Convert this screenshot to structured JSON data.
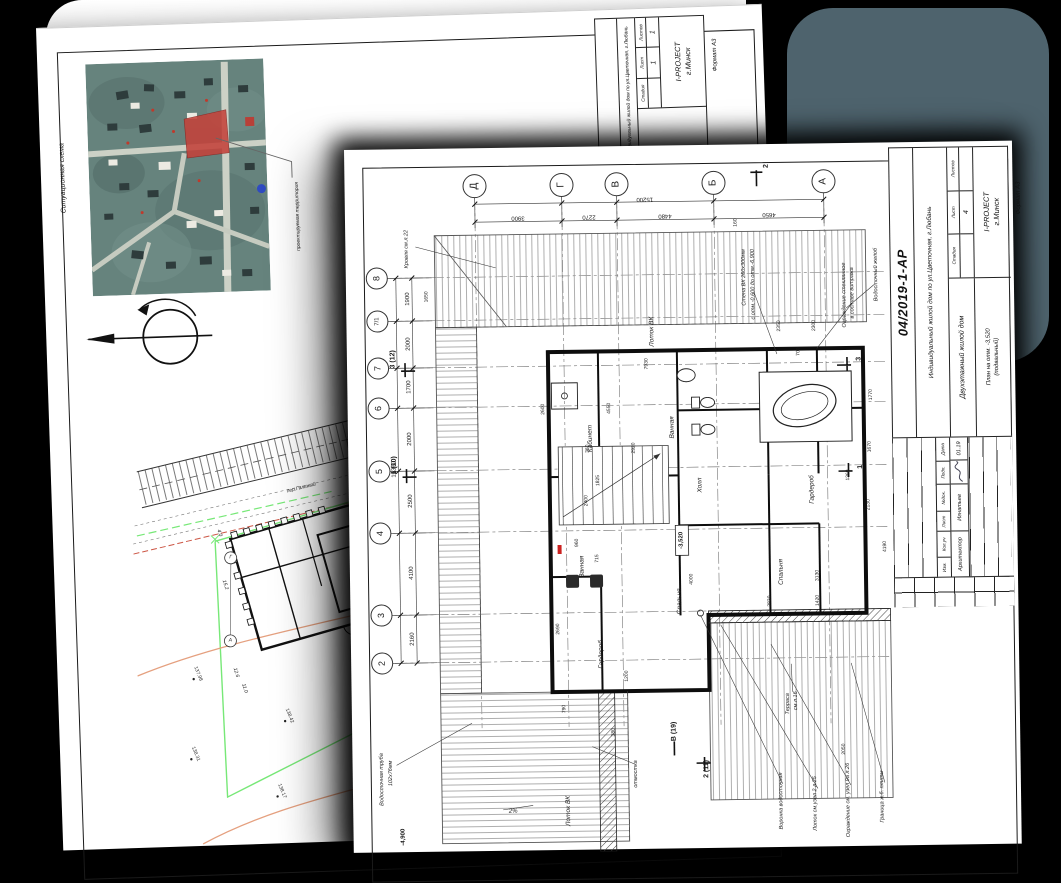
{
  "meta": {
    "slate_color": "#4e636d",
    "green": "#77e877",
    "orange": "#e5a07f",
    "parcel_red": "#c4423b",
    "dot_blue": "#2f4bc1"
  },
  "back_sheet": {
    "annotations": [
      {
        "t": "Ситуационная схема",
        "x": 22,
        "y": 150,
        "r": -90,
        "s": 7
      },
      {
        "t": "проектируемая территория",
        "x": 256,
        "y": 196,
        "r": -90,
        "s": 5
      }
    ],
    "site_labels": [
      {
        "t": "пер.Гальный",
        "x": 170,
        "y": 118,
        "r": -12,
        "s": 5
      },
      {
        "t": "4.0",
        "x": 86,
        "y": 160,
        "r": 75
      },
      {
        "t": "15.2",
        "x": 90,
        "y": 212,
        "r": 75
      },
      {
        "t": "12.6",
        "x": 98,
        "y": 300,
        "r": 75
      },
      {
        "t": "11.0",
        "x": 106,
        "y": 316,
        "r": 75
      },
      {
        "t": "32.2",
        "x": 240,
        "y": 282,
        "r": 70
      },
      {
        "t": "Г",
        "x": 97,
        "y": 185,
        "r": 0
      },
      {
        "t": "А",
        "x": 94,
        "y": 268,
        "r": 0
      }
    ],
    "spot_labels": [
      {
        "t": "138.42",
        "x": 150,
        "y": 345
      },
      {
        "t": "138.17",
        "x": 140,
        "y": 420
      },
      {
        "t": "138.40",
        "x": 230,
        "y": 330
      },
      {
        "t": "138.31",
        "x": 55,
        "y": 380
      },
      {
        "t": "138.19",
        "x": 238,
        "y": 415
      },
      {
        "t": "138.49",
        "x": 250,
        "y": 250
      },
      {
        "t": "137.98",
        "x": 60,
        "y": 300
      }
    ],
    "stamp": {
      "object": "Индивидуальный жилой дом по ул.Цветочная, г.Любань",
      "stage_h": "Стадия",
      "sheet_h": "Лист",
      "sheets_h": "Листов",
      "sheet_no": "1",
      "sheets_no": "1",
      "org1": "I-PROJECT",
      "org2": "г.Минск",
      "format": "Формат  А3"
    }
  },
  "front_sheet": {
    "axes_top": [
      {
        "t": "Д",
        "x": 130,
        "y": 38
      },
      {
        "t": "Г",
        "x": 217,
        "y": 38
      },
      {
        "t": "В",
        "x": 272,
        "y": 38
      },
      {
        "t": "Б",
        "x": 369,
        "y": 38
      },
      {
        "t": "А",
        "x": 479,
        "y": 38
      }
    ],
    "axes_left": [
      {
        "t": "8",
        "x": 31,
        "y": 129
      },
      {
        "t": "7/1",
        "x": 31,
        "y": 172,
        "s": 6
      },
      {
        "t": "7",
        "x": 31,
        "y": 219
      },
      {
        "t": "6",
        "x": 31,
        "y": 259
      },
      {
        "t": "5",
        "x": 31,
        "y": 322
      },
      {
        "t": "4",
        "x": 31,
        "y": 384
      },
      {
        "t": "3",
        "x": 31,
        "y": 466
      },
      {
        "t": "2",
        "x": 31,
        "y": 514
      }
    ],
    "dims_top": [
      {
        "t": "15200",
        "x": 300,
        "y": 53
      },
      {
        "t": "3900",
        "x": 173,
        "y": 70
      },
      {
        "t": "2270",
        "x": 244,
        "y": 70
      },
      {
        "t": "4480",
        "x": 320,
        "y": 70
      },
      {
        "t": "4650",
        "x": 424,
        "y": 70
      }
    ],
    "dims_left": [
      {
        "t": "16360",
        "x": 46,
        "y": 320
      },
      {
        "t": "1900",
        "x": 62,
        "y": 150
      },
      {
        "t": "2000",
        "x": 62,
        "y": 195
      },
      {
        "t": "1700",
        "x": 62,
        "y": 238
      },
      {
        "t": "2000",
        "x": 62,
        "y": 290
      },
      {
        "t": "2500",
        "x": 62,
        "y": 352
      },
      {
        "t": "4100",
        "x": 62,
        "y": 424
      },
      {
        "t": "2160",
        "x": 62,
        "y": 490
      }
    ],
    "plan_dims": [
      {
        "t": "4550",
        "x": 262,
        "y": 262
      },
      {
        "t": "2920",
        "x": 286,
        "y": 302
      },
      {
        "t": "1825",
        "x": 250,
        "y": 334
      },
      {
        "t": "2400",
        "x": 238,
        "y": 354
      },
      {
        "t": "2350",
        "x": 433,
        "y": 182
      },
      {
        "t": "2300",
        "x": 468,
        "y": 182
      },
      {
        "t": "700",
        "x": 452,
        "y": 208
      },
      {
        "t": "1770",
        "x": 524,
        "y": 252
      },
      {
        "t": "1670",
        "x": 522,
        "y": 304
      },
      {
        "t": "2130",
        "x": 520,
        "y": 362
      },
      {
        "t": "1650",
        "x": 81,
        "y": 148
      },
      {
        "t": "160",
        "x": 391,
        "y": 78
      },
      {
        "t": "3130",
        "x": 468,
        "y": 432
      },
      {
        "t": "4000",
        "x": 342,
        "y": 434
      },
      {
        "t": "2830",
        "x": 420,
        "y": 457
      },
      {
        "t": "1420",
        "x": 468,
        "y": 457
      },
      {
        "t": "2050",
        "x": 492,
        "y": 606
      },
      {
        "t": "790",
        "x": 213,
        "y": 562
      },
      {
        "t": "380",
        "x": 262,
        "y": 586
      },
      {
        "t": "1200",
        "x": 276,
        "y": 530
      },
      {
        "t": "4190",
        "x": 536,
        "y": 404
      },
      {
        "t": "2690",
        "x": 208,
        "y": 482
      },
      {
        "t": "2600",
        "x": 196,
        "y": 262
      },
      {
        "t": "960",
        "x": 228,
        "y": 396
      },
      {
        "t": "715",
        "x": 248,
        "y": 412
      },
      {
        "t": "360",
        "x": 240,
        "y": 302
      },
      {
        "t": "1360",
        "x": 500,
        "y": 332
      },
      {
        "t": "7930",
        "x": 300,
        "y": 218
      }
    ],
    "rooms": [
      {
        "t": "Кабинет",
        "x": 243,
        "y": 292
      },
      {
        "t": "Ванная",
        "x": 325,
        "y": 282
      },
      {
        "t": "Ванная",
        "x": 233,
        "y": 420
      },
      {
        "t": "Спальня",
        "x": 330,
        "y": 456
      },
      {
        "t": "Спальня",
        "x": 432,
        "y": 428
      },
      {
        "t": "Гардероб",
        "x": 464,
        "y": 346
      },
      {
        "t": "Гардероб",
        "x": 251,
        "y": 508
      },
      {
        "t": "Холл",
        "x": 352,
        "y": 340
      },
      {
        "t": "Лоток ВК",
        "x": 306,
        "y": 186
      },
      {
        "t": "Лоток ВК",
        "x": 216,
        "y": 664
      }
    ],
    "callouts": [
      {
        "t": "Кровля см.л.22",
        "x": 62,
        "y": 100
      },
      {
        "t": "Водосточный желоб",
        "x": 531,
        "y": 132
      },
      {
        "t": "Ограждение стеклянное",
        "x": 499,
        "y": 152
      },
      {
        "t": "в составе витража",
        "x": 507,
        "y": 150
      },
      {
        "t": "Стена ВК 260х300мм",
        "x": 399,
        "y": 133
      },
      {
        "t": "с отм.-0,600 до отм.-6,900",
        "x": 408,
        "y": 140
      },
      {
        "t": "Водосточная труба",
        "x": 30,
        "y": 630
      },
      {
        "t": "102х76мм",
        "x": 39,
        "y": 624
      },
      {
        "t": "отмостка",
        "x": 284,
        "y": 628
      },
      {
        "t": "Терраса",
        "x": 437,
        "y": 560
      },
      {
        "t": "см.л.16",
        "x": 445,
        "y": 557
      },
      {
        "t": "Воронка водосточная",
        "x": 429,
        "y": 657
      },
      {
        "t": "Лоток см.узел 2 л.25",
        "x": 463,
        "y": 660
      },
      {
        "t": "Ограждение см. узел 9а л.26",
        "x": 496,
        "y": 657
      },
      {
        "t": "Граница ж.б. плиты",
        "x": 530,
        "y": 654
      },
      {
        "t": "2%",
        "x": 160,
        "y": 664,
        "r": 0,
        "s": 6
      }
    ],
    "sections": [
      {
        "t": "2",
        "x": 422,
        "y": 22
      },
      {
        "t": "3 (12)",
        "x": 46,
        "y": 210
      },
      {
        "t": "1 (10)",
        "x": 46,
        "y": 316
      },
      {
        "t": "3",
        "x": 512,
        "y": 216
      },
      {
        "t": "1",
        "x": 512,
        "y": 324
      },
      {
        "t": "2 (11)",
        "x": 354,
        "y": 624
      },
      {
        "t": "В (19)",
        "x": 322,
        "y": 586
      }
    ],
    "markers": [
      {
        "t": "-3,520",
        "x": 332,
        "y": 395
      },
      {
        "t": "-4,900",
        "x": 50,
        "y": 688
      }
    ],
    "stamp": {
      "doc": "04/2019-1-АР",
      "object": "Индивидуальный жилой дом по ул.Цветочная, г.Любань",
      "building": "Двухэтажный жилой дом",
      "drawing": "План на отм. -3,520",
      "drawing2": "(подвальный)",
      "stage_h": "Стадия",
      "sheet_h": "Лист",
      "sheets_h": "Листов",
      "sheet_no": "4",
      "org1": "I-PROJECT",
      "org2": "г.Минск",
      "format": "Формат  А3",
      "rev": [
        "Изм.",
        "Кол.уч",
        "Лист",
        "№док.",
        "Подп.",
        "Дата"
      ],
      "role": "Архитектор",
      "name": "Игнатьев",
      "date": "01.19"
    }
  }
}
